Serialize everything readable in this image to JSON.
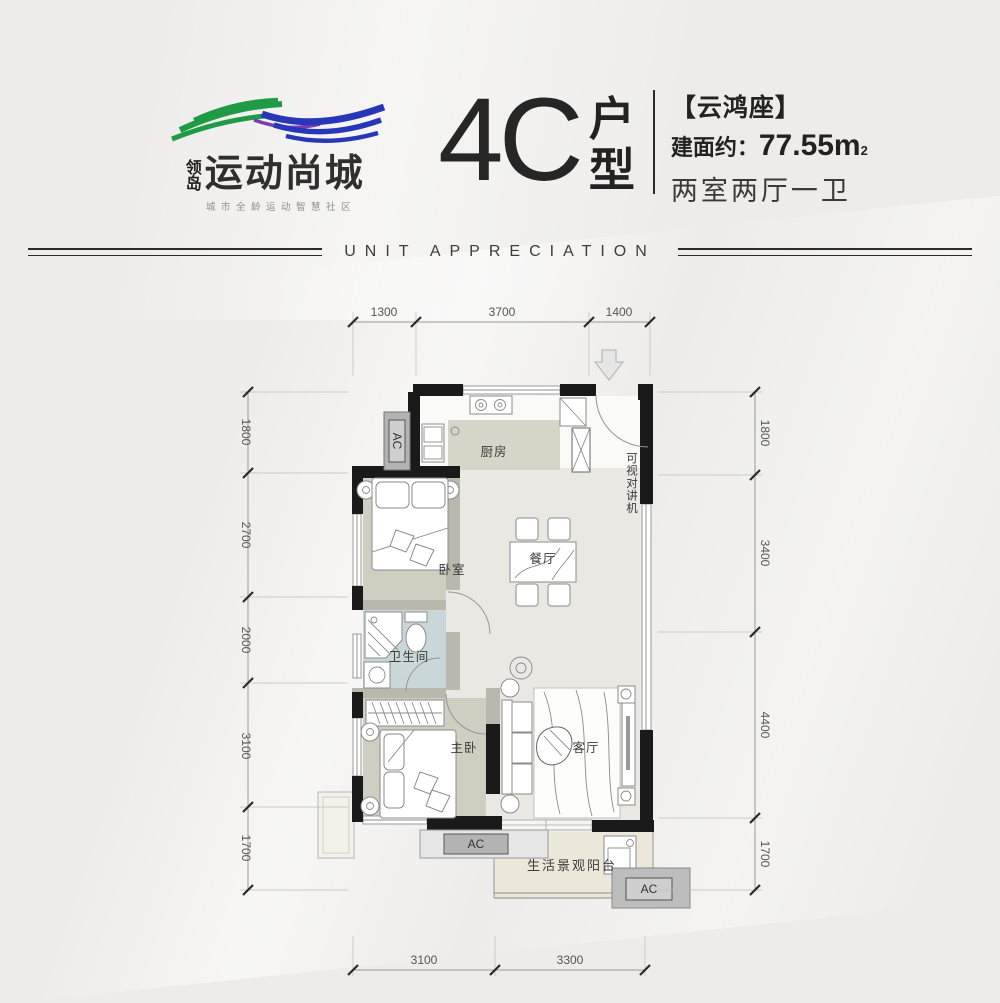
{
  "colors": {
    "page-bg": "#edecea",
    "wall": "#1a1a1a",
    "inner-wall": "#bab8ac",
    "floor-hall": "#e9e8e2",
    "floor-bed": "#d0cec1",
    "floor-counter": "#d7d5c7",
    "floor-bath": "#c9d7d9",
    "floor-balcony": "#ebe7d9",
    "floor-kitchen": "#fafaf7",
    "ac-outer": "#b3b3b3",
    "ac-inner": "#cfcfcf",
    "line": "#8b8b8b",
    "dim-line": "#9a9a9a",
    "dim-text": "#555555",
    "label-text": "#3c3c3c",
    "logo-green": "#1f9b45",
    "logo-blue": "#2836b8",
    "logo-purple": "#7a3cae",
    "title-text": "#262626"
  },
  "logo": {
    "mark": "领岛",
    "name": "运动尚城",
    "tagline": "城市全龄运动智慧社区"
  },
  "title": {
    "code": "4C",
    "suffix_top": "户",
    "suffix_bottom": "型"
  },
  "info": {
    "building": "【云鸿座】",
    "area_prefix": "建面约：",
    "area_value": "77.55m",
    "area_sup": "2",
    "layout": "两室两厅一卫"
  },
  "banner": {
    "text": "UNIT APPRECIATION"
  },
  "floorplan": {
    "rooms": {
      "kitchen": "厨房",
      "bedroom": "卧室",
      "dining": "餐厅",
      "bathroom": "卫生间",
      "master": "主卧",
      "living": "客厅",
      "balcony": "生活景观阳台"
    },
    "intercom": "可视对讲机",
    "ac": "AC",
    "dims": {
      "top": [
        "1300",
        "3700",
        "1400"
      ],
      "left": [
        "1800",
        "2700",
        "2000",
        "3100",
        "1700"
      ],
      "right": [
        "1800",
        "3400",
        "4400",
        "1700"
      ],
      "bottom": [
        "3100",
        "3300"
      ]
    }
  }
}
